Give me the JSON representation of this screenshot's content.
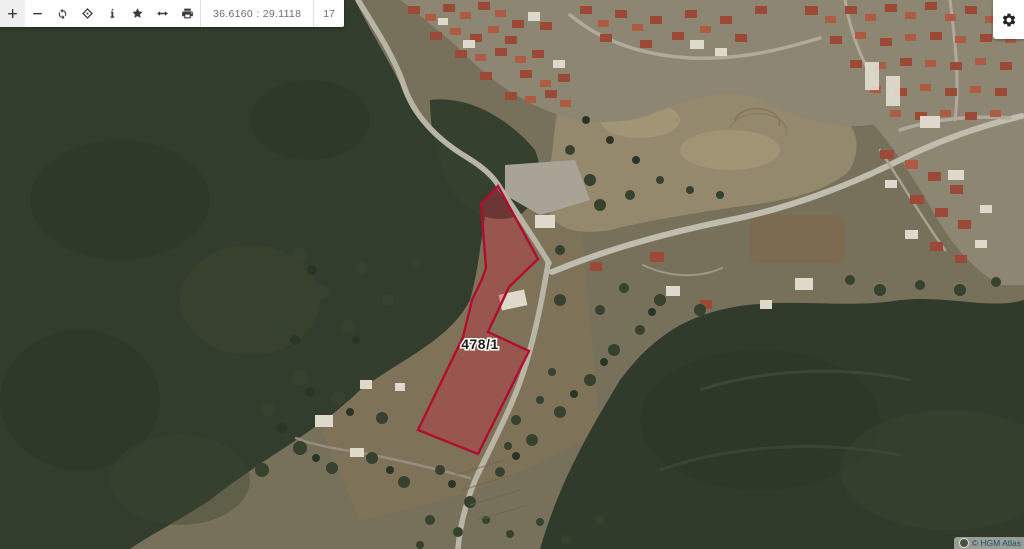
{
  "toolbar": {
    "coordinates": "36.6160 : 29.1118",
    "zoom_level": "17",
    "buttons": [
      {
        "name": "zoom-in",
        "icon": "plus-icon"
      },
      {
        "name": "zoom-out",
        "icon": "minus-icon"
      },
      {
        "name": "refresh",
        "icon": "refresh-icon"
      },
      {
        "name": "center-locate",
        "icon": "crosshair-icon"
      },
      {
        "name": "info",
        "icon": "info-icon"
      },
      {
        "name": "favorites",
        "icon": "star-icon"
      },
      {
        "name": "measure",
        "icon": "double-arrow-icon"
      },
      {
        "name": "print",
        "icon": "printer-icon"
      }
    ]
  },
  "settings_button": {
    "icon": "gear-icon"
  },
  "map": {
    "type": "satellite",
    "parcel": {
      "label": "478/1",
      "points": "498,186 538,259 509,287 488,332 529,351 478,454 418,430 463,337 472,300 482,279 486,268 481,204",
      "fill_color": "rgba(198,40,60,0.38)",
      "stroke_color": "#b00d2f",
      "label_x": "480",
      "label_y": "349"
    },
    "attribution": "© HGM Atlas"
  }
}
